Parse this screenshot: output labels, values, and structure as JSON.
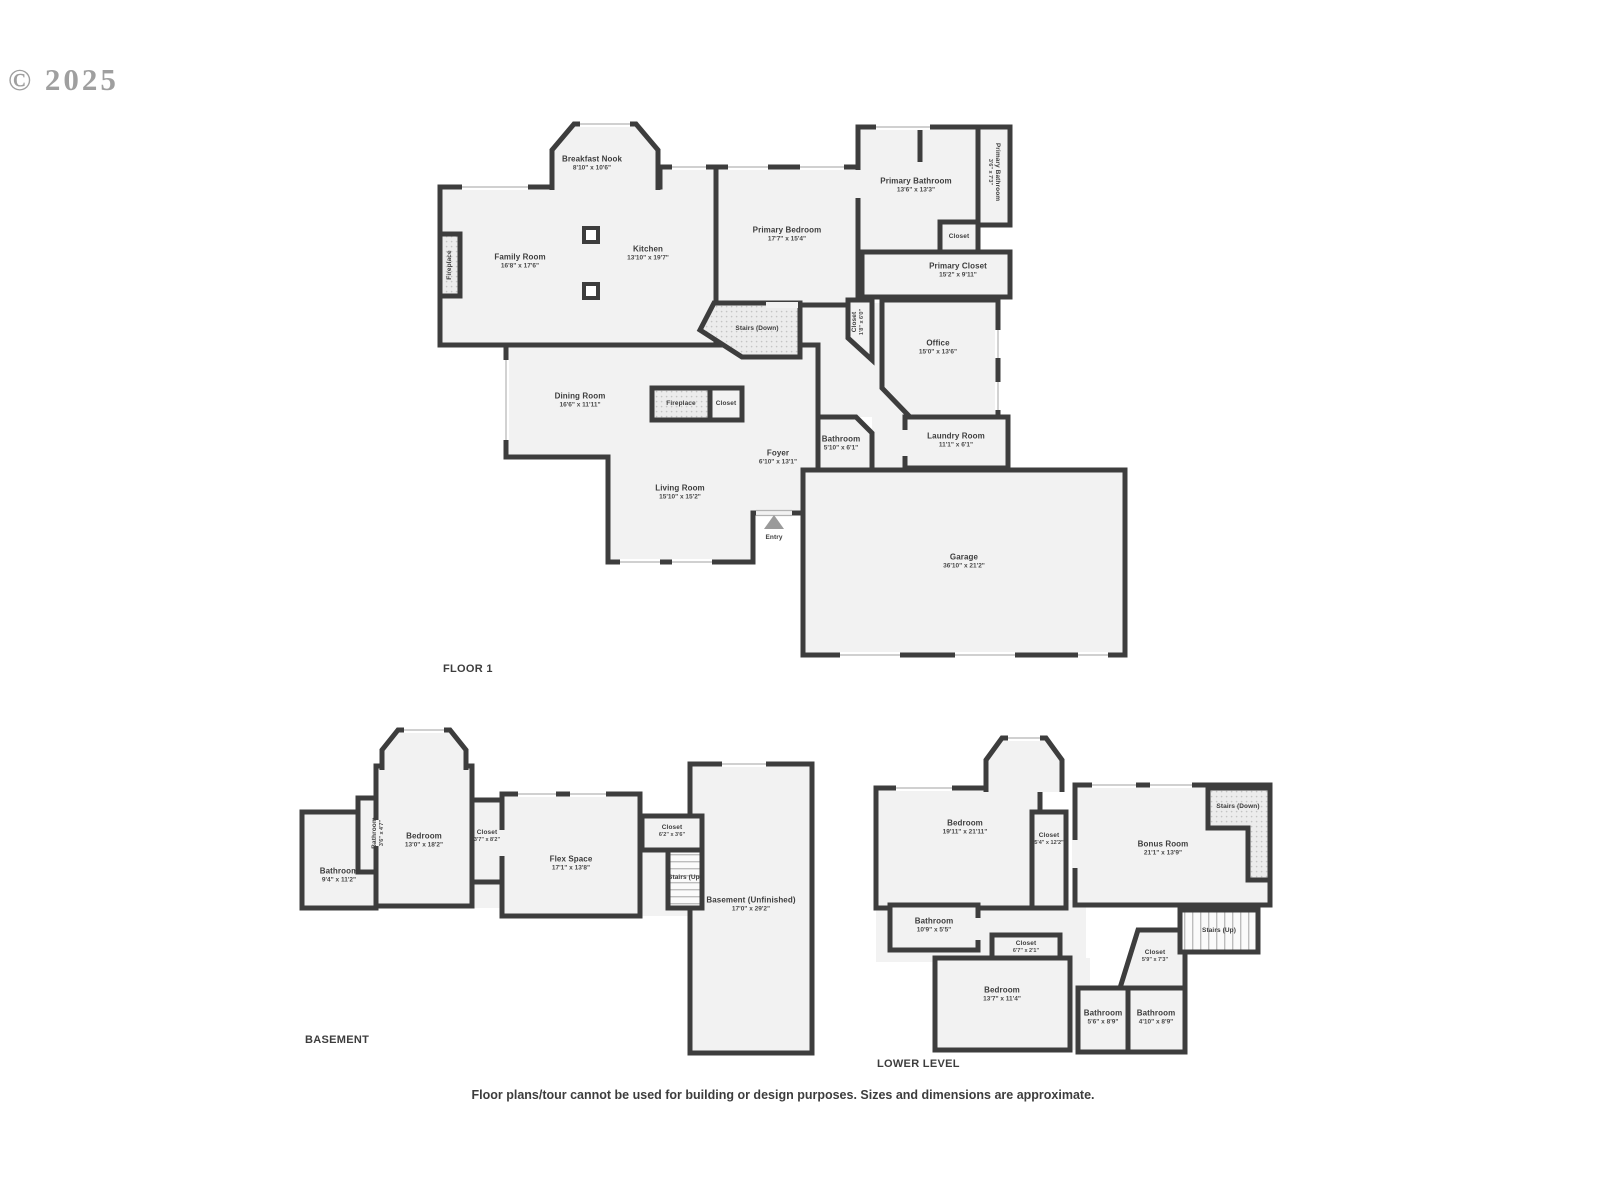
{
  "watermark": "© 2025",
  "disclaimer": "Floor plans/tour cannot be used for building or design purposes. Sizes and dimensions are approximate.",
  "colors": {
    "wall": "#3d3d3d",
    "floor": "#f2f2f2",
    "stairs_hatch": "#ececec",
    "text": "#3d3d3d",
    "watermark": "#8f8f8f"
  },
  "floor1": {
    "title": "FLOOR 1",
    "rooms": {
      "breakfast_nook": {
        "name": "Breakfast Nook",
        "dims": "8'10\" x 10'6\""
      },
      "family_room": {
        "name": "Family Room",
        "dims": "16'8\" x 17'6\""
      },
      "kitchen": {
        "name": "Kitchen",
        "dims": "13'10\" x 19'7\""
      },
      "fireplace_family": {
        "name": "Fireplace"
      },
      "primary_bedroom": {
        "name": "Primary Bedroom",
        "dims": "17'7\" x 15'4\""
      },
      "primary_bathroom": {
        "name": "Primary Bathroom",
        "dims": "13'6\" x 13'3\""
      },
      "primary_bathroom_small": {
        "name": "Primary Bathroom",
        "dims": "3'6\" x 7'3\""
      },
      "closet_bathroom": {
        "name": "Closet"
      },
      "primary_closet": {
        "name": "Primary Closet",
        "dims": "15'2\" x 9'11\""
      },
      "closet_hall": {
        "name": "Closet",
        "dims": "1'8\" x 6'0\""
      },
      "office": {
        "name": "Office",
        "dims": "15'0\" x 13'6\""
      },
      "stairs_down": {
        "name": "Stairs (Down)"
      },
      "dining_room": {
        "name": "Dining Room",
        "dims": "16'6\" x 11'11\""
      },
      "fireplace_center": {
        "name": "Fireplace"
      },
      "closet_center": {
        "name": "Closet"
      },
      "foyer": {
        "name": "Foyer",
        "dims": "6'10\" x 13'1\""
      },
      "bathroom": {
        "name": "Bathroom",
        "dims": "5'10\" x 6'1\""
      },
      "laundry_room": {
        "name": "Laundry Room",
        "dims": "11'1\" x 6'1\""
      },
      "living_room": {
        "name": "Living Room",
        "dims": "15'10\" x 15'2\""
      },
      "entry": {
        "name": "Entry"
      },
      "garage": {
        "name": "Garage",
        "dims": "36'10\" x 21'2\""
      }
    }
  },
  "basement": {
    "title": "BASEMENT",
    "rooms": {
      "bathroom": {
        "name": "Bathroom",
        "dims": "9'4\" x 11'2\""
      },
      "bathroom_small": {
        "name": "Bathroom",
        "dims": "3'6\" x 4'7\""
      },
      "bedroom": {
        "name": "Bedroom",
        "dims": "13'0\" x 18'2\""
      },
      "closet_1": {
        "name": "Closet",
        "dims": "3'7\" x 8'2\""
      },
      "flex_space": {
        "name": "Flex Space",
        "dims": "17'1\" x 13'8\""
      },
      "closet_2": {
        "name": "Closet",
        "dims": "6'2\" x 3'6\""
      },
      "stairs_up": {
        "name": "Stairs (Up)"
      },
      "basement_unfinished": {
        "name": "Basement (Unfinished)",
        "dims": "17'0\" x 29'2\""
      }
    }
  },
  "lower_level": {
    "title": "LOWER LEVEL",
    "rooms": {
      "bedroom_1": {
        "name": "Bedroom",
        "dims": "19'11\" x 21'11\""
      },
      "closet_1": {
        "name": "Closet",
        "dims": "5'4\" x 12'2\""
      },
      "bonus_room": {
        "name": "Bonus Room",
        "dims": "21'1\" x 13'9\""
      },
      "stairs_down": {
        "name": "Stairs (Down)"
      },
      "bathroom_1": {
        "name": "Bathroom",
        "dims": "10'9\" x 5'5\""
      },
      "closet_2": {
        "name": "Closet",
        "dims": "6'7\" x 2'1\""
      },
      "closet_3": {
        "name": "Closet",
        "dims": "5'9\" x 7'3\""
      },
      "stairs_up": {
        "name": "Stairs (Up)"
      },
      "bedroom_2": {
        "name": "Bedroom",
        "dims": "13'7\" x 11'4\""
      },
      "bathroom_2": {
        "name": "Bathroom",
        "dims": "5'6\" x 8'9\""
      },
      "bathroom_3": {
        "name": "Bathroom",
        "dims": "4'10\" x 8'9\""
      }
    }
  }
}
